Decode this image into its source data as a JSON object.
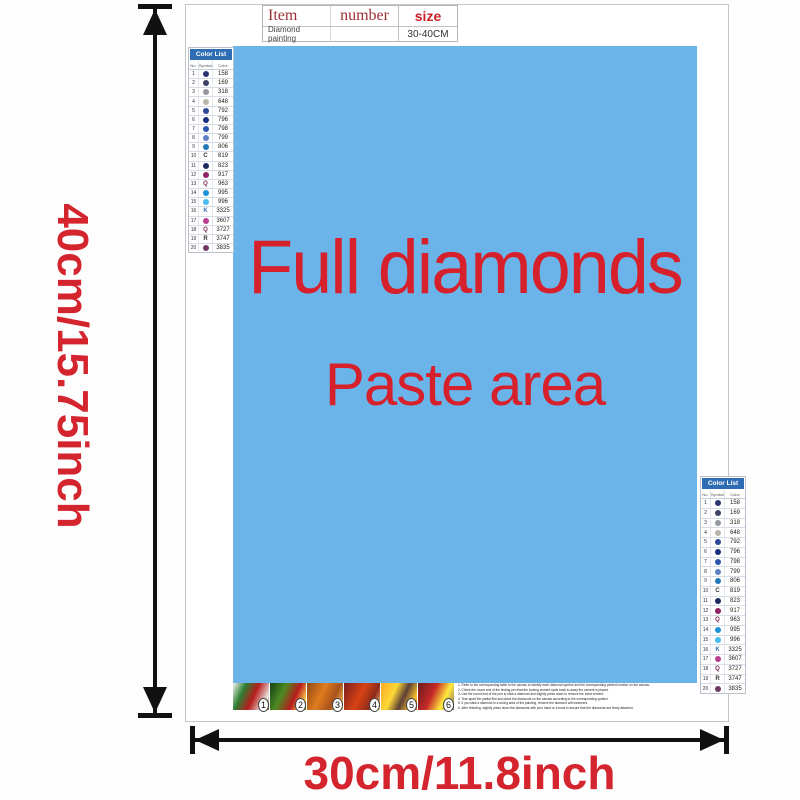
{
  "product_table": {
    "header": {
      "item": "Item",
      "number": "number",
      "size": "size"
    },
    "row": {
      "name": "Diamond painting",
      "size_value": "30-40CM"
    }
  },
  "paste_area": {
    "line1": "Full diamonds",
    "line2": "Paste area",
    "bg_color": "#6bb4e9",
    "text_color": "#d6202b"
  },
  "dimension_labels": {
    "height": "40cm/15.75inch",
    "width": "30cm/11.8inch",
    "color": "#d4252f"
  },
  "color_list": {
    "title": "Color List",
    "header_bg": "#2e6cb4",
    "columns": [
      "No.",
      "Symbol",
      "Color"
    ],
    "rows": [
      {
        "no": "1",
        "type": "circle",
        "fill": "#2a3570",
        "glyph": "",
        "code": "158"
      },
      {
        "no": "2",
        "type": "circle",
        "fill": "#3d4166",
        "glyph": "",
        "code": "169"
      },
      {
        "no": "3",
        "type": "circle",
        "fill": "#9598a0",
        "glyph": "",
        "code": "318"
      },
      {
        "no": "4",
        "type": "circle",
        "fill": "#b9b5ab",
        "glyph": "",
        "code": "648"
      },
      {
        "no": "5",
        "type": "circle",
        "fill": "#2c4796",
        "glyph": "",
        "code": "792"
      },
      {
        "no": "6",
        "type": "circle",
        "fill": "#162f7c",
        "glyph": "",
        "code": "796"
      },
      {
        "no": "7",
        "type": "circle",
        "fill": "#2b55ab",
        "glyph": "",
        "code": "798"
      },
      {
        "no": "8",
        "type": "circle",
        "fill": "#5f80c4",
        "glyph": "",
        "code": "799"
      },
      {
        "no": "9",
        "type": "circle",
        "fill": "#2478b8",
        "glyph": "",
        "code": "806"
      },
      {
        "no": "10",
        "type": "letter",
        "fill": "#333333",
        "glyph": "C",
        "code": "819"
      },
      {
        "no": "11",
        "type": "circle",
        "fill": "#1b2b60",
        "glyph": "",
        "code": "823"
      },
      {
        "no": "12",
        "type": "circle",
        "fill": "#8f2365",
        "glyph": "",
        "code": "917"
      },
      {
        "no": "13",
        "type": "letter",
        "fill": "#7a2350",
        "glyph": "Q",
        "code": "963"
      },
      {
        "no": "14",
        "type": "circle",
        "fill": "#1e90d8",
        "glyph": "",
        "code": "995"
      },
      {
        "no": "15",
        "type": "circle",
        "fill": "#45bcec",
        "glyph": "",
        "code": "996"
      },
      {
        "no": "16",
        "type": "letter",
        "fill": "#3a6ab0",
        "glyph": "K",
        "code": "3325"
      },
      {
        "no": "17",
        "type": "circle",
        "fill": "#ba3f90",
        "glyph": "",
        "code": "3607"
      },
      {
        "no": "18",
        "type": "letter",
        "fill": "#7a2350",
        "glyph": "Q",
        "code": "3727"
      },
      {
        "no": "19",
        "type": "letter",
        "fill": "#333333",
        "glyph": "R",
        "code": "3747"
      },
      {
        "no": "20",
        "type": "circle",
        "fill": "#6e3a62",
        "glyph": "",
        "code": "3835"
      }
    ]
  },
  "step_thumbnails": [
    {
      "num": "1",
      "gradient": "linear-gradient(115deg,#f5f5f0 0%,#2e7d32 28%,#b71c1c 55%,#e8e6e0 85%,#6d4c41 100%)"
    },
    {
      "num": "2",
      "gradient": "linear-gradient(115deg,#173f17 0%,#4c8a22 35%,#b71c1c 65%,#ffd54f 90%,#33691e 100%)"
    },
    {
      "num": "3",
      "gradient": "linear-gradient(115deg,#8d4a13 0%,#e07b1f 40%,#a8531a 70%,#ffcc66 100%)"
    },
    {
      "num": "4",
      "gradient": "linear-gradient(115deg,#7a1f1f 0%,#d84315 45%,#8e2a1a 75%,#ffd180 100%)"
    },
    {
      "num": "5",
      "gradient": "linear-gradient(115deg,#f9a825 0%,#fdd835 35%,#5d4037 60%,#fbc02d 85%,#e65100 100%)"
    },
    {
      "num": "6",
      "gradient": "linear-gradient(115deg,#6a1b1a 0%,#c62828 40%,#ffeb3b 70%,#8d6e63 100%)"
    }
  ],
  "instructions": {
    "lines": [
      "Refer to the corresponding table to the canvas to identify each diamond symbol and the corresponding printed number on the canvas.",
      "Check the round end of the finding pen that the locking cement cycle back to away the cement is placed.",
      "Use the round end of the pen to stick a diamond and slightly press down to remove the extra cement.",
      "Tear apart the partial film and place the diamonds on the canvas according to the corresponding symbol.",
      "If you stick a diamond in a wrong area of the painting, remove the diamond with tweezers.",
      "After finishing, slightly press down the diamonds with your hand or a book to ensure that the diamonds are firmly attached."
    ]
  }
}
